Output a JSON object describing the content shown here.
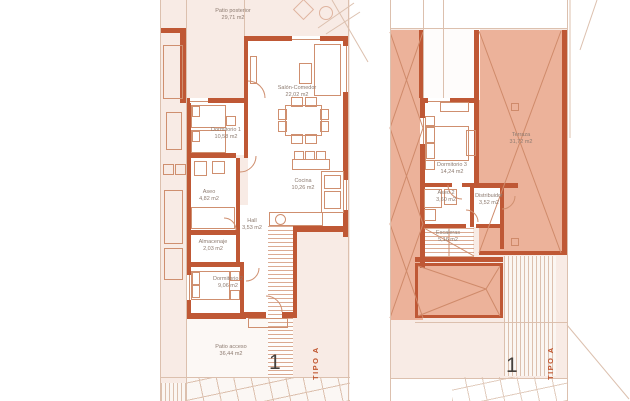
{
  "colors": {
    "wall": "#bf5835",
    "roof_fill": "#ecb29a",
    "roof_line": "#cf8a6a",
    "plot_fill": "#f8ebe5",
    "room_fill": "#ffffff",
    "furniture_line": "#cf8f6f",
    "label_text": "#8d7b70",
    "type_text": "#c0562f",
    "unit_number_text": "#45403c",
    "boundary_line": "#dcc0ae"
  },
  "plans": {
    "ground": {
      "unit_number": "1",
      "type_label": "TIPO A",
      "rooms": [
        {
          "name": "Patio posterior",
          "area": "29,71 m2"
        },
        {
          "name": "Salón-Comedor",
          "area": "22,02 m2"
        },
        {
          "name": "Dormitorio 1",
          "area": "10,58 m2"
        },
        {
          "name": "Aseo",
          "area": "4,82 m2"
        },
        {
          "name": "Cocina",
          "area": "10,26 m2"
        },
        {
          "name": "Hall",
          "area": "3,53 m2"
        },
        {
          "name": "Almacenaje",
          "area": "2,03 m2"
        },
        {
          "name": "Dormitorio 2",
          "area": "9,06 m2"
        },
        {
          "name": "Patio acceso",
          "area": "36,44 m2"
        }
      ]
    },
    "first": {
      "unit_number": "1",
      "type_label": "TIPO A",
      "rooms": [
        {
          "name": "Dormitorio 3",
          "area": "14,24 m2"
        },
        {
          "name": "Aseo 2",
          "area": "3,60 m2"
        },
        {
          "name": "Distribuidor",
          "area": "3,52 m2"
        },
        {
          "name": "Escaleras",
          "area": "5,16 m2"
        },
        {
          "name": "Terraza",
          "area": "31,72 m2"
        }
      ]
    }
  }
}
